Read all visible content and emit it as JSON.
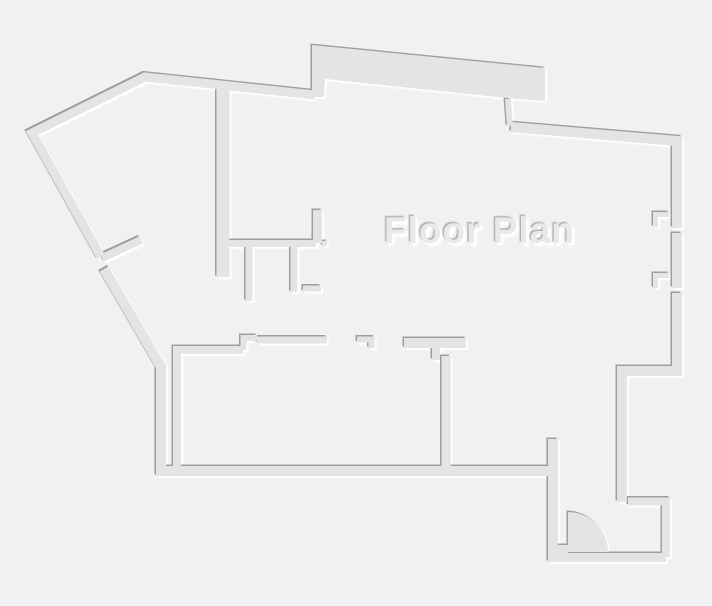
{
  "title": {
    "text": "Floor Plan"
  },
  "colors": {
    "background": "#f0f1f2",
    "wall_fill": "#e2e4e5",
    "edge_shadow_dark": "#98999b",
    "edge_highlight": "#ffffff",
    "title_text": "#e8eaea"
  },
  "floor_plan": {
    "canvas": {
      "width": 712,
      "height": 606
    },
    "door": {
      "kind": "quarter-circle-swing",
      "hinge_x": 568,
      "hinge_y": 552,
      "radius": 40
    },
    "walls": [
      {
        "name": "outer-wall-top-left",
        "type": "polyline",
        "width": 9,
        "points": [
          [
            101,
            257
          ],
          [
            32,
            133
          ],
          [
            145,
            77
          ],
          [
            315,
            95
          ]
        ]
      },
      {
        "name": "outer-wall-left-and-bottom",
        "type": "polyline",
        "width": 10,
        "points": [
          [
            104,
            269
          ],
          [
            161,
            367
          ],
          [
            161,
            471
          ],
          [
            556,
            471
          ]
        ]
      },
      {
        "name": "left-door-partition-stub",
        "type": "polyline",
        "width": 8,
        "points": [
          [
            102,
            258
          ],
          [
            141,
            240
          ]
        ]
      },
      {
        "name": "top-protrusion-slab",
        "type": "polygon",
        "points": [
          [
            312,
            45
          ],
          [
            545,
            68
          ],
          [
            545,
            101
          ],
          [
            507,
            98
          ],
          [
            325,
            79
          ],
          [
            324,
            97
          ],
          [
            312,
            97
          ]
        ]
      },
      {
        "name": "protrusion-step-wall",
        "type": "polyline",
        "width": 6,
        "points": [
          [
            508,
            99
          ],
          [
            510,
            126
          ]
        ]
      },
      {
        "name": "top-right-wall",
        "type": "polyline",
        "width": 10,
        "points": [
          [
            511,
            127
          ],
          [
            677,
            141
          ],
          [
            677,
            228
          ]
        ]
      },
      {
        "name": "right-wall-mid-segment",
        "type": "polyline",
        "width": 10,
        "points": [
          [
            677,
            233
          ],
          [
            677,
            288
          ]
        ]
      },
      {
        "name": "right-wall-lower-and-step",
        "type": "polyline",
        "width": 10,
        "points": [
          [
            677,
            293
          ],
          [
            677,
            371
          ],
          [
            622,
            371
          ],
          [
            622,
            502
          ]
        ]
      },
      {
        "name": "window-jamb-upper",
        "type": "polyline",
        "width": 5,
        "points": [
          [
            669,
            214.5
          ],
          [
            655.5,
            214.5
          ],
          [
            655.5,
            227
          ]
        ]
      },
      {
        "name": "window-jamb-lower",
        "type": "polyline",
        "width": 5,
        "points": [
          [
            669,
            275.5
          ],
          [
            655.5,
            275.5
          ],
          [
            655.5,
            288
          ]
        ]
      },
      {
        "name": "center-divider-wall",
        "type": "polyline",
        "width": 13,
        "points": [
          [
            223,
            84
          ],
          [
            223,
            277
          ]
        ]
      },
      {
        "name": "t-structure-horizontal",
        "type": "polyline",
        "width": 7,
        "points": [
          [
            227,
            243.5
          ],
          [
            316,
            243.5
          ]
        ]
      },
      {
        "name": "t-structure-riser",
        "type": "polyline",
        "width": 9,
        "points": [
          [
            317.5,
            210
          ],
          [
            317.5,
            243
          ]
        ]
      },
      {
        "name": "t-structure-dot",
        "type": "polyline",
        "width": 5,
        "points": [
          [
            322,
            243.5
          ],
          [
            327,
            243.5
          ]
        ]
      },
      {
        "name": "t-structure-stub-a",
        "type": "polyline",
        "width": 7,
        "points": [
          [
            249,
            247
          ],
          [
            249,
            301
          ]
        ]
      },
      {
        "name": "t-structure-stub-b",
        "type": "polyline",
        "width": 7,
        "points": [
          [
            294,
            247
          ],
          [
            294,
            292
          ]
        ]
      },
      {
        "name": "t-structure-foot",
        "type": "polyline",
        "width": 6,
        "points": [
          [
            303,
            288.5
          ],
          [
            321,
            288.5
          ]
        ]
      },
      {
        "name": "room1-left-and-top-wall",
        "type": "polyline",
        "width": 8,
        "points": [
          [
            177,
            466
          ],
          [
            177,
            350
          ],
          [
            243,
            350
          ]
        ]
      },
      {
        "name": "room1-door-step",
        "type": "polyline",
        "width": 6,
        "points": [
          [
            243.5,
            350
          ],
          [
            243.5,
            338
          ],
          [
            257,
            338
          ]
        ]
      },
      {
        "name": "room2-top-wall",
        "type": "polyline",
        "width": 7,
        "points": [
          [
            257,
            340
          ],
          [
            327,
            340
          ]
        ]
      },
      {
        "name": "room2-door-jamb",
        "type": "polyline",
        "width": 6,
        "points": [
          [
            357,
            339.5
          ],
          [
            371.5,
            339.5
          ],
          [
            371.5,
            348
          ]
        ]
      },
      {
        "name": "room3-top-bar",
        "type": "polyline",
        "width": 10,
        "points": [
          [
            404,
            343
          ],
          [
            466,
            343
          ]
        ]
      },
      {
        "name": "room3-step",
        "type": "polyline",
        "width": 8,
        "points": [
          [
            436,
            347
          ],
          [
            436,
            360
          ]
        ]
      },
      {
        "name": "room3-divider-wall",
        "type": "polyline",
        "width": 9,
        "points": [
          [
            446,
            356
          ],
          [
            446,
            466
          ]
        ]
      },
      {
        "name": "corridor-wall",
        "type": "polyline",
        "width": 10,
        "points": [
          [
            553,
            439
          ],
          [
            553,
            557
          ]
        ]
      },
      {
        "name": "entry-bottom-wall",
        "type": "polyline",
        "width": 9,
        "points": [
          [
            548,
            557.5
          ],
          [
            666,
            557.5
          ]
        ]
      },
      {
        "name": "entry-right-wall",
        "type": "polyline",
        "width": 8,
        "points": [
          [
            628,
            501.5
          ],
          [
            666,
            501.5
          ],
          [
            666,
            557
          ]
        ]
      },
      {
        "name": "door-hinge-stub",
        "type": "polyline",
        "width": 8,
        "points": [
          [
            556,
            549
          ],
          [
            568,
            549
          ]
        ]
      },
      {
        "name": "entry-door-leaf",
        "type": "path",
        "d": "M568,552 L568,512 A40 40 0 0 1 608,552 Z"
      }
    ]
  }
}
